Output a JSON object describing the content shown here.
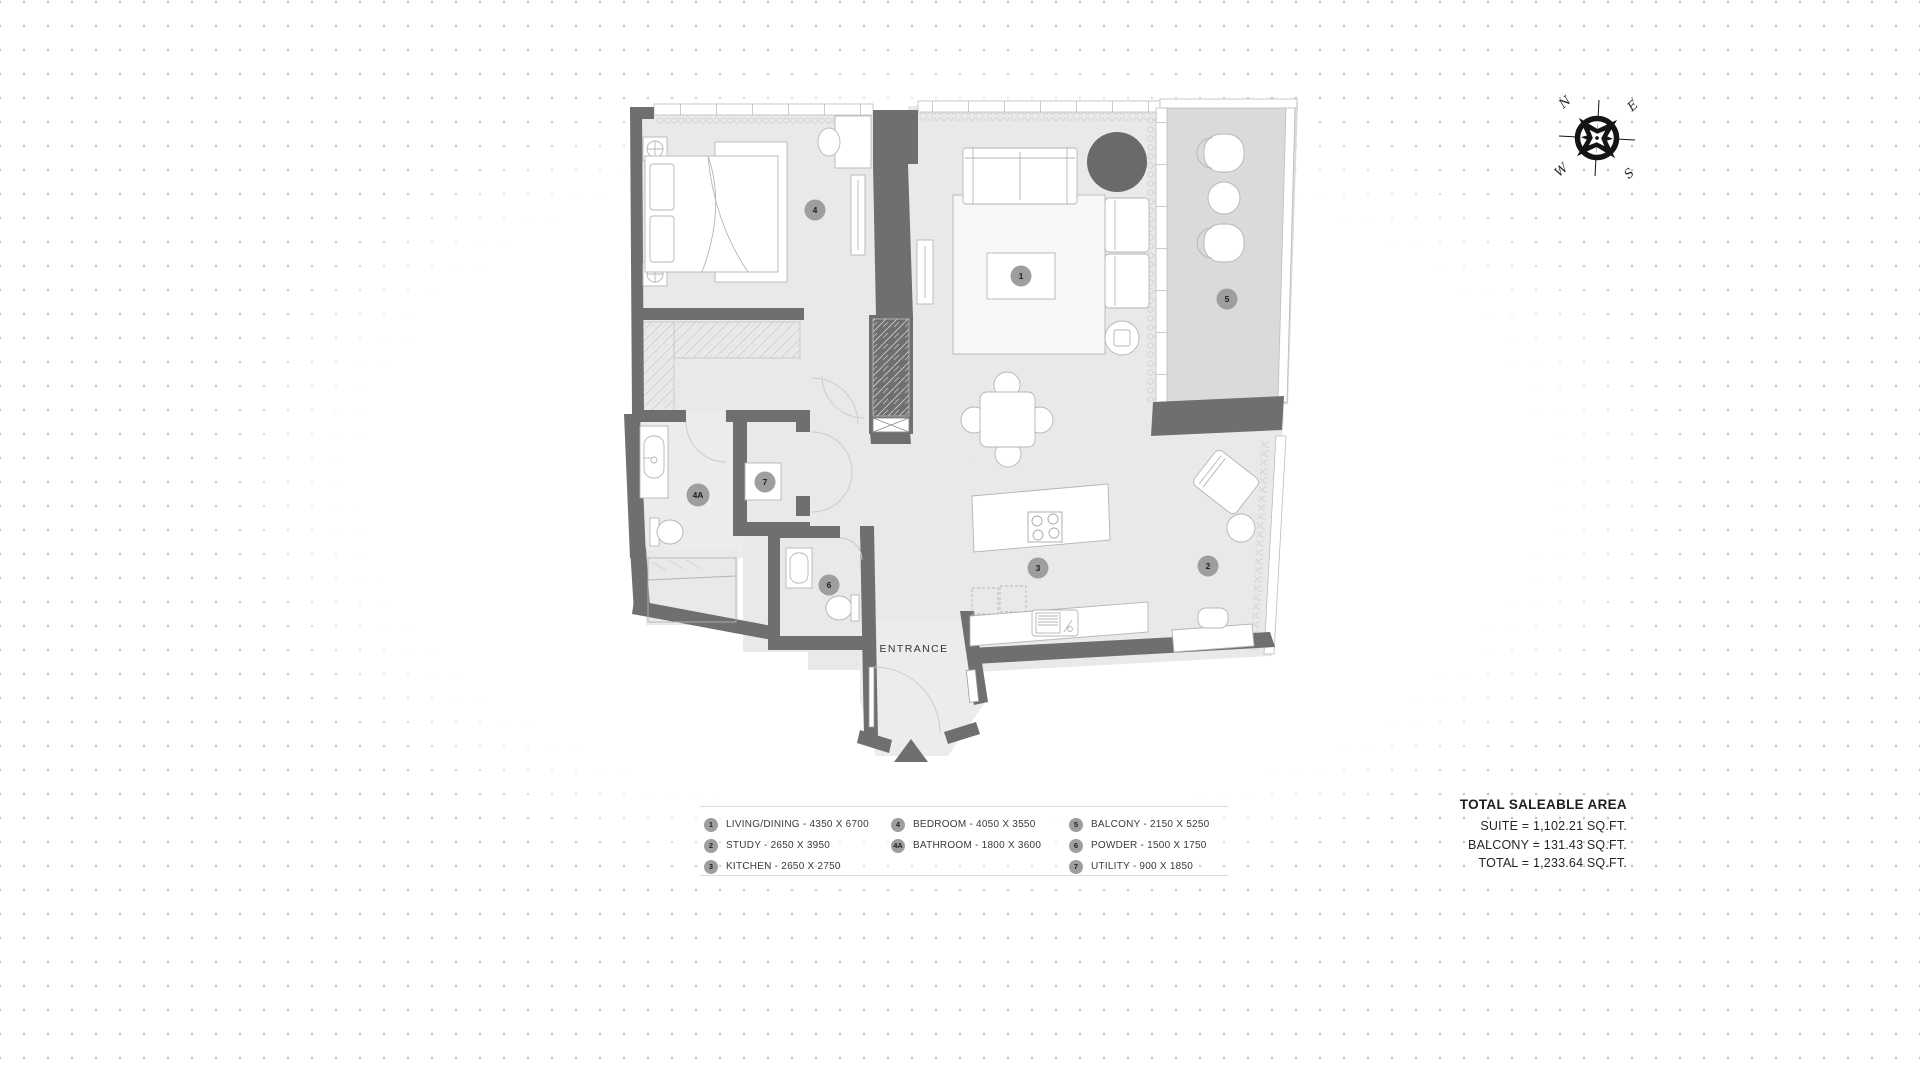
{
  "compass": {
    "n": "N",
    "e": "E",
    "s": "S",
    "w": "W"
  },
  "plan": {
    "entrance_label": "ENTRANCE",
    "badges": [
      {
        "num": "1"
      },
      {
        "num": "2"
      },
      {
        "num": "3"
      },
      {
        "num": "4"
      },
      {
        "num": "4A"
      },
      {
        "num": "5"
      },
      {
        "num": "6"
      },
      {
        "num": "7"
      }
    ]
  },
  "legend": {
    "columns": [
      {
        "items": [
          {
            "num": "1",
            "label": "LIVING/DINING - 4350 X 6700"
          },
          {
            "num": "2",
            "label": "STUDY - 2650 X 3950"
          },
          {
            "num": "3",
            "label": "KITCHEN - 2650 X 2750"
          }
        ]
      },
      {
        "items": [
          {
            "num": "4",
            "label": "BEDROOM - 4050 X 3550"
          },
          {
            "num": "4A",
            "label": "BATHROOM - 1800 X 3600"
          }
        ]
      },
      {
        "items": [
          {
            "num": "5",
            "label": "BALCONY - 2150 X 5250"
          },
          {
            "num": "6",
            "label": "POWDER - 1500 X 1750"
          },
          {
            "num": "7",
            "label": "UTILITY - 900 X 1850"
          }
        ]
      }
    ]
  },
  "area_summary": {
    "title": "TOTAL SALEABLE AREA",
    "lines": [
      "SUITE = 1,102.21 SQ.FT.",
      "BALCONY = 131.43 SQ.FT.",
      "TOTAL = 1,233.64 SQ.FT."
    ]
  },
  "colors": {
    "wall": "#6f6f6f",
    "floor": "#e9e9e9",
    "balcony_floor": "#dadada",
    "badge": "#9e9e9e",
    "dark_accent": "#6a6a6a"
  }
}
